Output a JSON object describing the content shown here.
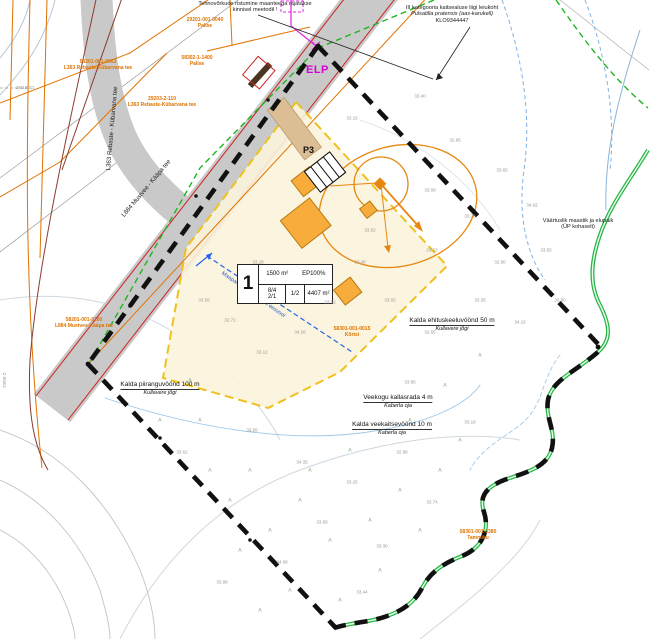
{
  "map": {
    "plan_type": "detail-plan-site-drawing",
    "colors": {
      "road_gray": "#c9c9c9",
      "boundary_black": "#111111",
      "envelope_fill": "#fbf3da",
      "envelope_dash": "#efc11e",
      "building_orange": "#f7ac3c",
      "utility_orange": "#e07300",
      "stream_green": "#28b548",
      "magenta": "#d400d4",
      "drainage_blue": "#2257c4",
      "road_edge_red": "#cc2222"
    },
    "notes": {
      "top_note_line1": "Tehnovõrkude ristumine maanteega rajatakse",
      "top_note_line2": "kinnisel meetodil !",
      "species_line1": "III kategooria kaitsealuse liigi leiukoht",
      "species_line2": "Pulsatilla pratensis (aas-karukell)",
      "species_line3": "KLO9344447",
      "right_note_line1": "Väärtuslik maastik ja elupaik",
      "right_note_line2": "(ÜP kohaselt)"
    },
    "elp_label": "ELP",
    "p3_label": "P3",
    "drainage_label": "Maaparandussüsteemi eesvool",
    "survey_point": "26/15011",
    "survey_vertical": "73/09-2",
    "plot": {
      "number": "1",
      "area_top": "1500 m²",
      "ep": "EP100%",
      "v1": "8/4",
      "v2": "2/1",
      "v3": "1/2",
      "size": "4407 m²"
    },
    "cadastral": [
      {
        "line1": "29201-001-0040",
        "line2": "Palise"
      },
      {
        "line1": "58302-1-1400",
        "line2": "Palise"
      },
      {
        "line1": "58201-001-0063",
        "line2": "L363 Rebaste-Kübarvana tee"
      },
      {
        "line1": "29203-2-110",
        "line2": "L363 Rebaste-Kübarvana tee"
      },
      {
        "line1": "58201-001-0160",
        "line2": "L884 Mustvee-Kääpa tee"
      },
      {
        "line1": "58301-001-0015",
        "line2": "Kõrtsi"
      },
      {
        "line1": "58301-001-0380",
        "line2": "Tammiku"
      }
    ],
    "zones": [
      {
        "line1": "Kalda piiranguvöönd 100 m",
        "line2": "Kullavere jõgi"
      },
      {
        "line1": "Kalda ehituskeeluvöönd 50 m",
        "line2": "Kullavere jõgi"
      },
      {
        "line1": "Veekogu kallasrada 4 m",
        "line2": "Kaberla oja"
      },
      {
        "line1": "Kalda veekaitsevöönd 10 m",
        "line2": "Kaberla oja"
      }
    ],
    "roads": [
      {
        "label": "L363 Rebaste - Kübarvana tee"
      },
      {
        "label": "L884 Mustvee - Kääpa tee"
      }
    ],
    "vegetation_glyph": "⋏",
    "elevation_marks": [
      {
        "x": 352,
        "y": 118,
        "v": "33.15"
      },
      {
        "x": 420,
        "y": 96,
        "v": "33.40"
      },
      {
        "x": 455,
        "y": 140,
        "v": "32.95"
      },
      {
        "x": 502,
        "y": 170,
        "v": "33.65"
      },
      {
        "x": 532,
        "y": 205,
        "v": "34.02"
      },
      {
        "x": 470,
        "y": 216,
        "v": "33.78"
      },
      {
        "x": 432,
        "y": 250,
        "v": "33.22"
      },
      {
        "x": 500,
        "y": 262,
        "v": "32.80"
      },
      {
        "x": 546,
        "y": 250,
        "v": "33.55"
      },
      {
        "x": 560,
        "y": 300,
        "v": "33.90"
      },
      {
        "x": 520,
        "y": 322,
        "v": "34.15"
      },
      {
        "x": 480,
        "y": 300,
        "v": "33.35"
      },
      {
        "x": 430,
        "y": 332,
        "v": "32.65"
      },
      {
        "x": 390,
        "y": 300,
        "v": "33.05"
      },
      {
        "x": 360,
        "y": 262,
        "v": "33.48"
      },
      {
        "x": 330,
        "y": 302,
        "v": "33.82"
      },
      {
        "x": 300,
        "y": 332,
        "v": "34.28"
      },
      {
        "x": 262,
        "y": 352,
        "v": "33.12"
      },
      {
        "x": 230,
        "y": 320,
        "v": "32.72"
      },
      {
        "x": 204,
        "y": 300,
        "v": "33.58"
      },
      {
        "x": 252,
        "y": 430,
        "v": "33.95"
      },
      {
        "x": 302,
        "y": 462,
        "v": "34.35"
      },
      {
        "x": 352,
        "y": 482,
        "v": "33.25"
      },
      {
        "x": 402,
        "y": 452,
        "v": "32.88"
      },
      {
        "x": 322,
        "y": 522,
        "v": "33.68"
      },
      {
        "x": 282,
        "y": 562,
        "v": "34.08"
      },
      {
        "x": 382,
        "y": 546,
        "v": "33.30"
      },
      {
        "x": 432,
        "y": 502,
        "v": "33.74"
      },
      {
        "x": 470,
        "y": 422,
        "v": "33.18"
      },
      {
        "x": 182,
        "y": 452,
        "v": "33.62"
      },
      {
        "x": 222,
        "y": 582,
        "v": "33.98"
      },
      {
        "x": 362,
        "y": 592,
        "v": "33.44"
      },
      {
        "x": 430,
        "y": 190,
        "v": "33.08"
      },
      {
        "x": 370,
        "y": 230,
        "v": "33.52"
      },
      {
        "x": 410,
        "y": 382,
        "v": "33.86"
      },
      {
        "x": 258,
        "y": 262,
        "v": "33.28"
      }
    ],
    "vegetation_marks": [
      {
        "x": 250,
        "y": 470
      },
      {
        "x": 300,
        "y": 500
      },
      {
        "x": 330,
        "y": 540
      },
      {
        "x": 370,
        "y": 520
      },
      {
        "x": 270,
        "y": 530
      },
      {
        "x": 310,
        "y": 470
      },
      {
        "x": 350,
        "y": 450
      },
      {
        "x": 230,
        "y": 500
      },
      {
        "x": 200,
        "y": 420
      },
      {
        "x": 400,
        "y": 490
      },
      {
        "x": 420,
        "y": 530
      },
      {
        "x": 290,
        "y": 590
      },
      {
        "x": 340,
        "y": 600
      },
      {
        "x": 380,
        "y": 570
      },
      {
        "x": 240,
        "y": 550
      },
      {
        "x": 440,
        "y": 470
      },
      {
        "x": 460,
        "y": 440
      },
      {
        "x": 410,
        "y": 420
      },
      {
        "x": 190,
        "y": 380
      },
      {
        "x": 210,
        "y": 470
      },
      {
        "x": 160,
        "y": 420
      },
      {
        "x": 260,
        "y": 610
      },
      {
        "x": 445,
        "y": 385
      },
      {
        "x": 480,
        "y": 355
      }
    ]
  }
}
